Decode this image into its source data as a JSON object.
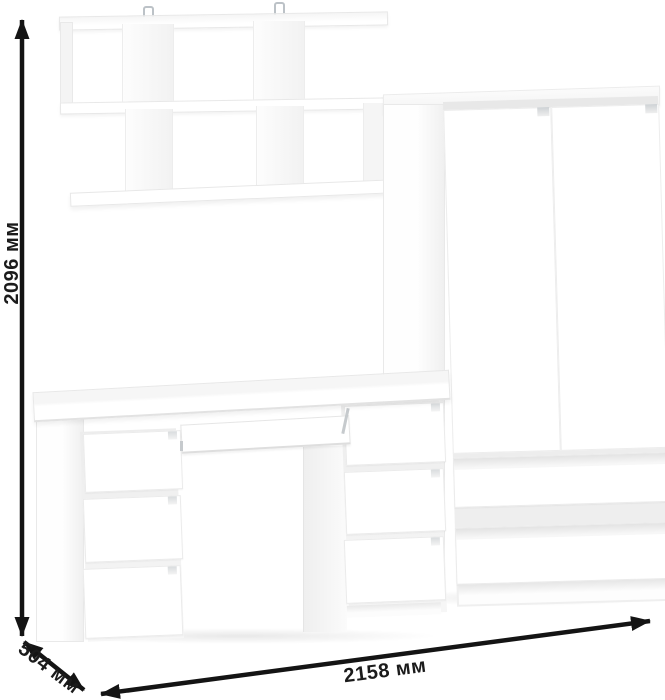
{
  "dimensions": {
    "height": "2096 мм",
    "depth": "504 мм",
    "width": "2158 мм"
  },
  "colors": {
    "background": "#ffffff",
    "furniture": "#ffffff",
    "furniture_shade": "#f0f0f0",
    "arrow": "#141414",
    "label_text": "#1b1b1b"
  }
}
